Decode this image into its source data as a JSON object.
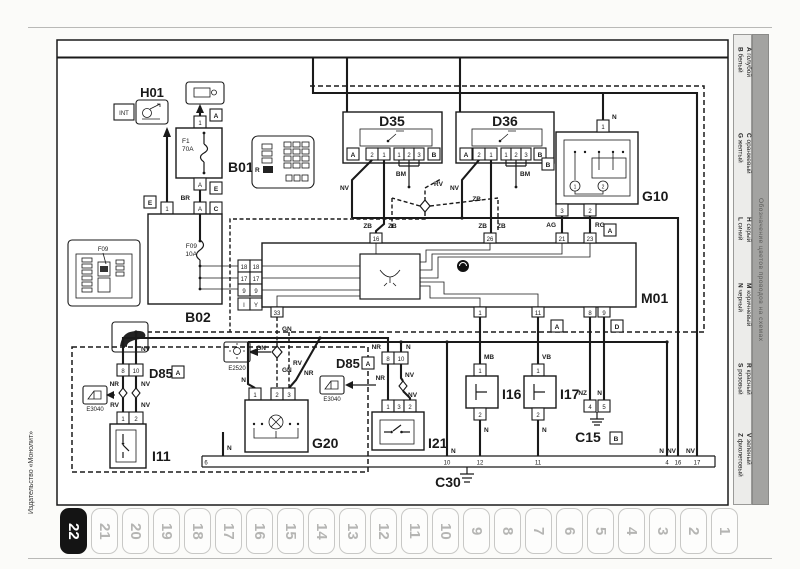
{
  "page": {
    "title": "ПОТОЛОЧНАЯ ЛАМПА САЛОНА",
    "publisher": "Издательство «Монолит»",
    "active_tab": "22"
  },
  "tabs": [
    "22",
    "21",
    "20",
    "19",
    "18",
    "17",
    "16",
    "15",
    "14",
    "13",
    "12",
    "11",
    "10",
    "9",
    "8",
    "7",
    "6",
    "5",
    "4",
    "3",
    "2",
    "1"
  ],
  "legend": {
    "title": "Обозначение цветов проводов на схемах",
    "entries": [
      {
        "code": "A",
        "name": "голубой"
      },
      {
        "code": "B",
        "name": "белый"
      },
      {
        "code": "C",
        "name": "оранжевый"
      },
      {
        "code": "G",
        "name": "желтый"
      },
      {
        "code": "H",
        "name": "серый"
      },
      {
        "code": "L",
        "name": "синий"
      },
      {
        "code": "M",
        "name": "коричневый"
      },
      {
        "code": "N",
        "name": "черный"
      },
      {
        "code": "R",
        "name": "красный"
      },
      {
        "code": "S",
        "name": "роз­овый"
      },
      {
        "code": "V",
        "name": "зеленый"
      },
      {
        "code": "Z",
        "name": "фиолетовый"
      }
    ]
  },
  "labels": {
    "h01": "H01",
    "b01": "B01",
    "b02": "B02",
    "d35": "D35",
    "d36": "D36",
    "g10": "G10",
    "m01": "M01",
    "d85": "D85",
    "i11": "I11",
    "i21": "I21",
    "g20": "G20",
    "i16": "I16",
    "i17": "I17",
    "c15": "C15",
    "c30": "C30",
    "e2520": "E2520",
    "e3040": "E3040",
    "int": "INT",
    "f09_callout": "F09",
    "r": "R",
    "f1_name": "F1",
    "f1_rating": "70A",
    "f09_name": "F09",
    "f09_rating": "10A"
  },
  "conn": {
    "a": "A",
    "b": "B",
    "c": "C",
    "d": "D",
    "e": "E",
    "i": "I",
    "y": "Y"
  },
  "wire": {
    "nv": "NV",
    "zb": "ZB",
    "bm": "BM",
    "rv": "RV",
    "br": "BR",
    "gn": "GN",
    "nr": "NR",
    "n": "N",
    "mb": "MB",
    "vb": "VB",
    "nz": "NZ",
    "ag": "AG",
    "rg": "RG"
  },
  "pins": {
    "1": "1",
    "2": "2",
    "3": "3",
    "4": "4",
    "5": "5",
    "6": "6",
    "8": "8",
    "9": "9",
    "10": "10",
    "11": "11",
    "12": "12",
    "16": "16",
    "17": "17",
    "18": "18",
    "21": "21",
    "23": "23",
    "26": "26",
    "33": "33"
  }
}
